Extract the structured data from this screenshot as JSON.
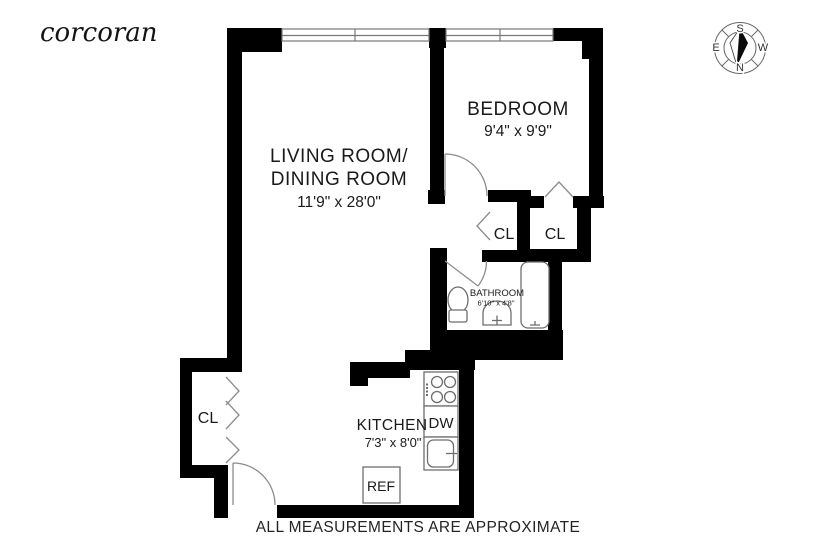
{
  "brand": {
    "logo": "corcoran"
  },
  "footer": {
    "disclaimer": "ALL MEASUREMENTS ARE APPROXIMATE"
  },
  "compass": {
    "north": "N",
    "south": "S",
    "east": "E",
    "west": "W"
  },
  "rooms": {
    "living": {
      "line1": "LIVING ROOM/",
      "line2": "DINING ROOM",
      "dims": "11'9\" x 28'0\""
    },
    "bedroom": {
      "name": "BEDROOM",
      "dims": "9'4\" x 9'9\""
    },
    "kitchen": {
      "name": "KITCHEN",
      "dims": "7'3\" x 8'0\""
    },
    "bathroom": {
      "name": "BATHROOM",
      "dims": "6'10\" x 4'8\""
    },
    "closets": {
      "hall": "CL",
      "bedroom": "CL",
      "entry": "CL"
    }
  },
  "appliances": {
    "dishwasher": "DW",
    "refrigerator": "REF"
  },
  "colors": {
    "wall": "#000000",
    "fixture_line": "#6e6e6e",
    "door_line": "#8c8c8c",
    "text": "#1a1a1a"
  }
}
